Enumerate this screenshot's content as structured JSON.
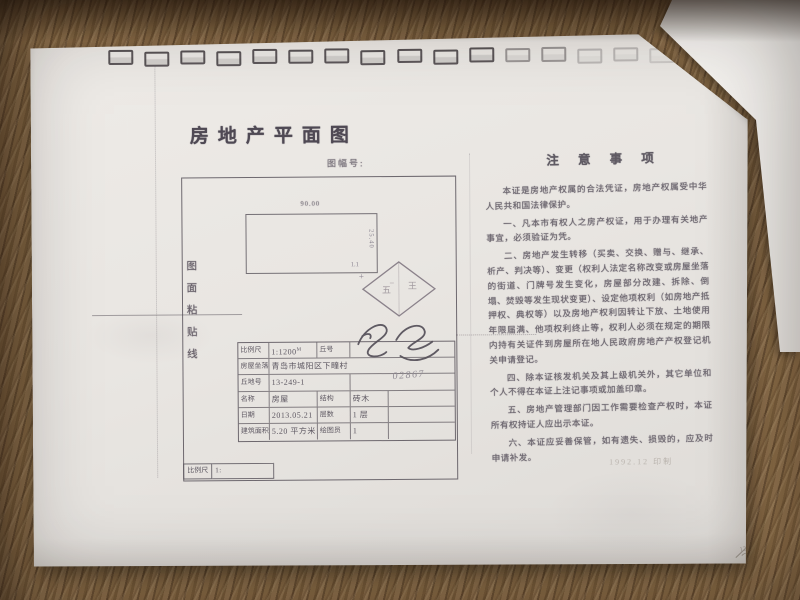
{
  "colors": {
    "wood": "#7d6343",
    "paper": "#e9e6e2",
    "ink": "#5b5560",
    "stamp_ink": "#8b828b"
  },
  "doc": {
    "title": "房地产平面图",
    "sheet_label": "图幅号:",
    "paste_line": [
      "图",
      "面",
      "粘",
      "贴",
      "线"
    ],
    "plan": {
      "top_dim": "90.00",
      "right_dim": "25.40",
      "corner_note": "1.1",
      "cross_mark": "+"
    },
    "stamp": {
      "left_char": "五",
      "right_char": "王"
    },
    "scale_box": {
      "label": "比例尺",
      "value": "1:"
    },
    "table": {
      "r1c1": "比例尺",
      "r1c2": "1:1200",
      "r1c2_sup": "M",
      "r1c3": "丘号",
      "r1c4": "",
      "r2c1": "房屋坐落",
      "r2c2": "青岛市城阳区下疃村",
      "r3c1": "丘地号",
      "r3c2": "13-249-1",
      "r4c1": "名称",
      "r4c2": "房屋",
      "r4c3": "结构",
      "r4c4": "砖木",
      "r5c1": "日期",
      "r5c2": "2013.05.21",
      "r5c3": "层数",
      "r5c4": "1 层",
      "r6c1": "建筑面积",
      "r6c2": "5.20 平方米",
      "r6c3": "绘图员",
      "r6c4": "1"
    },
    "hand_number": "02867",
    "notes": {
      "title": "注 意 事 项",
      "paragraphs": [
        "本证是房地产权属的合法凭证，房地产权属受中华人民共和国法律保护。",
        "一、凡本市有权人之房产权证，用于办理有关地产事宜，必须验证为凭。",
        "二、房地产发生转移（买卖、交换、赠与、继承、析产、判决等）、变更（权利人法定名称改变或房屋坐落的街道、门牌号发生变化，房屋部分改建、拆除、倒塌、焚毁等发生现状变更）、设定他项权利（如房地产抵押权、典权等）以及房地产权利因转让下放、土地使用年限届满、他项权利终止等，权利人必须在规定的期限内持有关证件到房屋所在地人民政府房地产产权登记机关申请登记。",
        "四、除本证核发机关及其上级机关外，其它单位和个人不得在本证上注记事项或加盖印章。",
        "五、房地产管理部门因工作需要检查产权时，本证所有权持证人应出示本证。",
        "六、本证应妥善保管，如有遗失、损毁的，应及时申请补发。"
      ]
    },
    "footer_print": "1992.12  印制",
    "corner_mark": "126"
  }
}
